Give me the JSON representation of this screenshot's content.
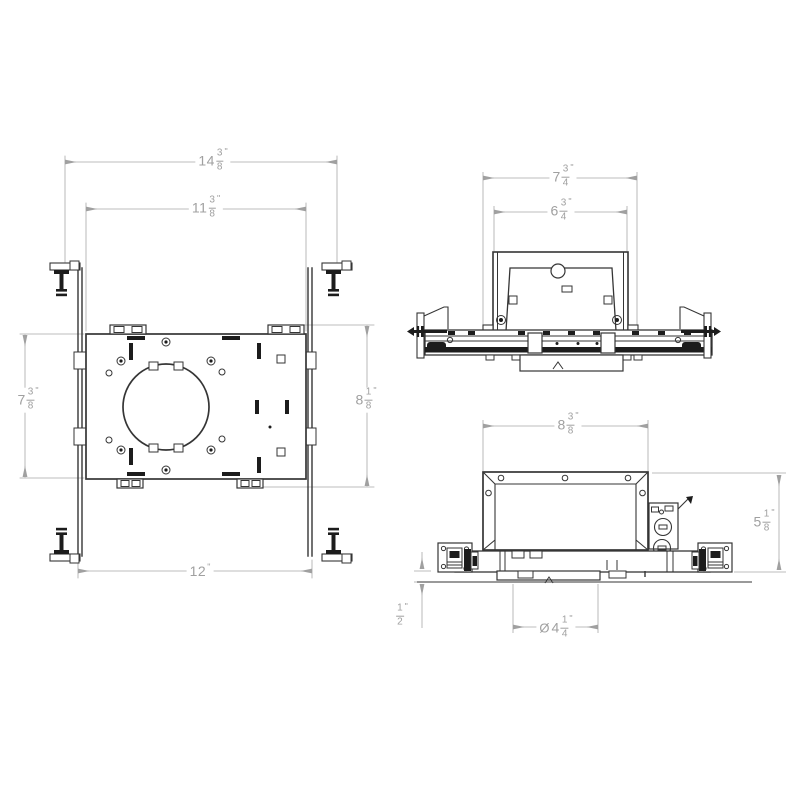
{
  "page": {
    "background": "#ffffff",
    "line_color": "#353535",
    "dark_fill": "#1c1c1c",
    "dim_color": "#a0a0a0"
  },
  "views": {
    "plan": {
      "label": "plan-view",
      "dims": {
        "overall_width": {
          "whole": "14",
          "num": "3",
          "den": "8",
          "unit": "\""
        },
        "plate_width": {
          "whole": "11",
          "num": "3",
          "den": "8",
          "unit": "\""
        },
        "plate_height": {
          "whole": "7",
          "num": "3",
          "den": "8",
          "unit": "\""
        },
        "overall_height": {
          "whole": "8",
          "num": "1",
          "den": "8",
          "unit": "\""
        },
        "bar_span": {
          "whole": "12",
          "unit": "\""
        }
      }
    },
    "front": {
      "label": "front-view",
      "dims": {
        "flange_width": {
          "whole": "7",
          "num": "3",
          "den": "4",
          "unit": "\""
        },
        "can_width": {
          "whole": "6",
          "num": "3",
          "den": "4",
          "unit": "\""
        }
      }
    },
    "side": {
      "label": "side-view",
      "dims": {
        "housing_width": {
          "whole": "8",
          "num": "3",
          "den": "8",
          "unit": "\""
        },
        "housing_height": {
          "whole": "5",
          "num": "1",
          "den": "8",
          "unit": "\""
        },
        "trim_recess": {
          "num": "1",
          "den": "2",
          "unit": "\""
        },
        "aperture": {
          "prefix": "Ø",
          "whole": "4",
          "num": "1",
          "den": "4",
          "unit": "\""
        }
      }
    }
  }
}
